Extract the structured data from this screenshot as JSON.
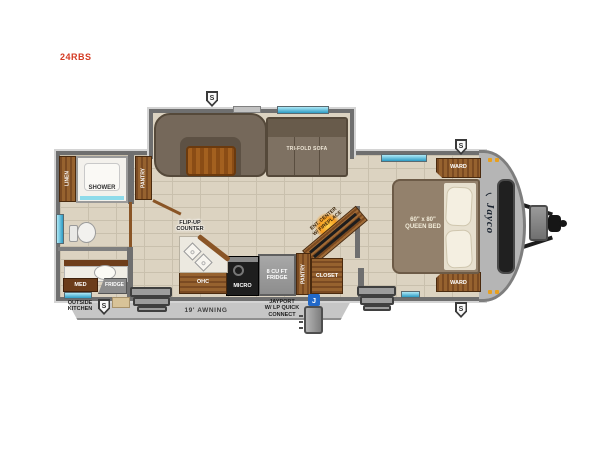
{
  "model_number": "24RBS",
  "brand": "Jayco",
  "badges": {
    "solar": "S",
    "jayport": "J"
  },
  "exterior": {
    "awning": "19' AWNING",
    "jayport_line1": "JAYPORT",
    "jayport_line2": "W/ LP QUICK",
    "jayport_line3": "CONNECT",
    "outside_kitchen_line1": "OUTSIDE",
    "outside_kitchen_line2": "KITCHEN"
  },
  "living": {
    "sofa": "TRI-FOLD SOFA"
  },
  "bedroom": {
    "ward": "WARD",
    "bed_size": "60\" x 80\"",
    "bed_type": "QUEEN BED"
  },
  "kitchen": {
    "flip_up_line1": "FLIP-UP",
    "flip_up_line2": "COUNTER",
    "ohc": "OHC",
    "micro": "MICRO",
    "fridge_line1": "8 CU FT",
    "fridge_line2": "FRIDGE",
    "pantry": "PANTRY",
    "closet": "CLOSET",
    "ent_line1": "ENT. CENTER",
    "ent_line2": "W/ FIREPLACE"
  },
  "bath": {
    "linen": "LINEN",
    "shower": "SHOWER",
    "pantry": "PANTRY",
    "med": "MED",
    "fridge": "FRIDGE"
  },
  "colors": {
    "window_blue": "#7fd9ef",
    "window_blue_dark": "#2e9cc4",
    "amber_light": "#e8a01e",
    "badge_blue": "#2168c8",
    "wood": "#8a5526",
    "wall_gray": "#6f6f6f",
    "floor": "#dcd3c1"
  }
}
